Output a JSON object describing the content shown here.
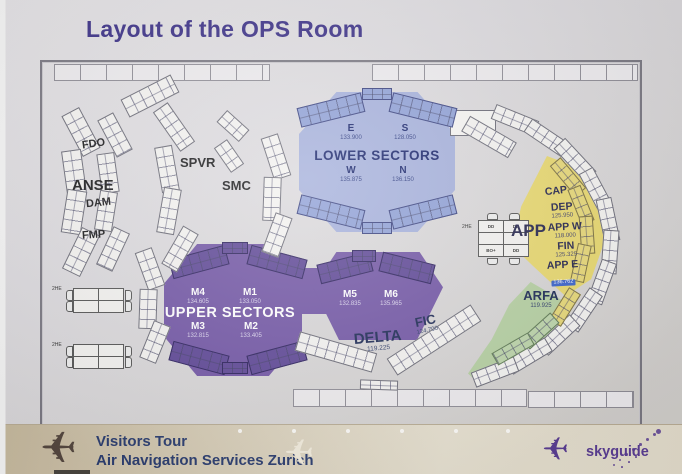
{
  "title": "Layout of the OPS Room",
  "zones": {
    "lower_sectors": {
      "label": "LOWER SECTORS",
      "positions": [
        {
          "name": "E",
          "freq": "133.900"
        },
        {
          "name": "S",
          "freq": "128.050"
        },
        {
          "name": "W",
          "freq": "135.875"
        },
        {
          "name": "N",
          "freq": "136.150"
        }
      ]
    },
    "upper_sectors": {
      "label": "UPPER SECTORS",
      "positions": [
        {
          "name": "M4",
          "freq": "134.605"
        },
        {
          "name": "M1",
          "freq": "133.050"
        },
        {
          "name": "M3",
          "freq": "132.815"
        },
        {
          "name": "M2",
          "freq": "133.405"
        },
        {
          "name": "M5",
          "freq": "132.835"
        },
        {
          "name": "M6",
          "freq": "135.965"
        }
      ]
    },
    "approach": {
      "label": "APP",
      "positions": [
        {
          "name": "CAP",
          "freq": ""
        },
        {
          "name": "DEP",
          "freq": "125.950"
        },
        {
          "name": "APP W",
          "freq": "118.000"
        },
        {
          "name": "FIN",
          "freq": "125.325"
        },
        {
          "name": "APP E",
          "freq": "136.762"
        }
      ]
    },
    "arfa": {
      "name": "ARFA",
      "freq": "119.925"
    },
    "delta": {
      "name": "DELTA",
      "freq": "119.225"
    },
    "fic": {
      "name": "FIC",
      "freq": "124.700"
    }
  },
  "workstations": {
    "fdo": "FDO",
    "anse": "ANSE",
    "dam": "DAM",
    "fmp": "FMP",
    "spvr": "SPVR",
    "smc": "SMC"
  },
  "clusters": {
    "rack_label": "2HE",
    "app_cluster_cells": [
      "DD",
      "DD",
      "",
      "",
      "BO+",
      "DD"
    ]
  },
  "footer": {
    "line1": "Visitors Tour",
    "line2": "Air Navigation Services Zurich",
    "brand": "skyguide"
  },
  "colors": {
    "title": "#3c3187",
    "lower_sectors": "#a5b0db",
    "upper_sectors": "#7256a5",
    "approach": "#e7d76f",
    "arfa": "#b5cfa2",
    "highlight_chip": "#3b63c9",
    "brand": "#5b3e93"
  }
}
